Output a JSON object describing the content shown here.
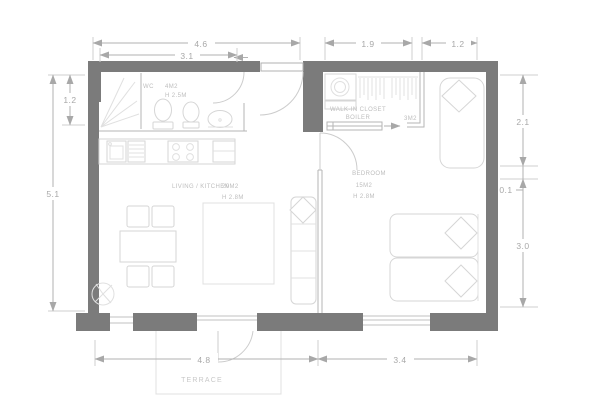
{
  "drawing": {
    "type": "apartment-floor-plan",
    "units": "meters"
  },
  "rooms": {
    "wc": {
      "name": "WC",
      "area": "4M2",
      "height": "H 2.5M"
    },
    "living": {
      "name": "LIVING / KITCHEN",
      "area": "20M2",
      "height": "H 2.8M"
    },
    "bedroom": {
      "name": "BEDROOM",
      "area": "15M2",
      "height": "H 2.8M"
    },
    "closet": {
      "name": "WALK-IN CLOSET",
      "sub": "BOILER",
      "area": "3M2"
    },
    "terrace": {
      "name": "TERRACE"
    }
  },
  "dimensions": {
    "top_overall": "4.6",
    "top_wc": "3.1",
    "top_closet": "1.9",
    "top_entry": "1.2",
    "left_wc": "1.2",
    "left_overall": "5.1",
    "right_closet": "2.1",
    "right_wall": "0.1",
    "right_bedroom": "3.0",
    "bottom_living": "4.8",
    "bottom_bedroom": "3.4"
  },
  "colors": {
    "wall": "#7b7b7b",
    "line": "#c2c2c2",
    "furniture": "#d6d6d6",
    "text": "#bdbdbd",
    "dim": "#a8a8a8"
  }
}
